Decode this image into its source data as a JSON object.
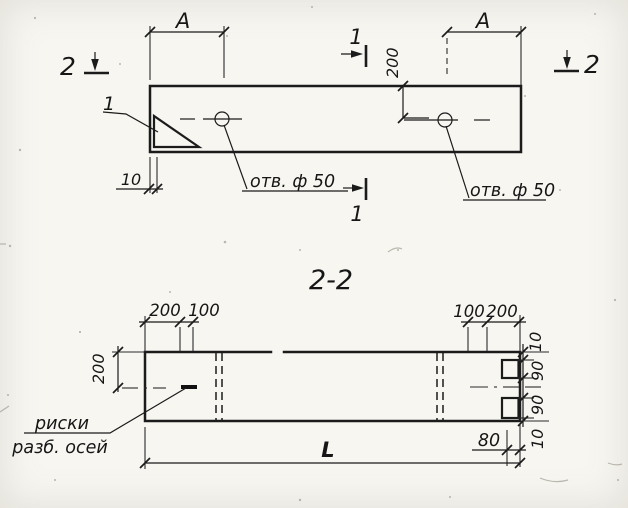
{
  "top_view": {
    "dim_a_left": "А",
    "dim_a_right": "А",
    "dim_200": "200",
    "dim_10": "10",
    "hole_label_left": "отв. ф 50",
    "hole_label_right": "отв. ф 50",
    "section_1_top": "1",
    "section_1_bottom": "1",
    "section_2_left": "2",
    "section_2_right": "2",
    "detail_label": "1"
  },
  "section_view": {
    "title": "2-2",
    "dims_top_left": [
      "200",
      "100"
    ],
    "dims_top_right": [
      "100",
      "200"
    ],
    "dim_left": "200",
    "dims_right": [
      "10",
      "90",
      "90",
      "10"
    ],
    "dim_80": "80",
    "dim_length": "L",
    "note_line1": "риски",
    "note_line2": "разб. осей"
  }
}
